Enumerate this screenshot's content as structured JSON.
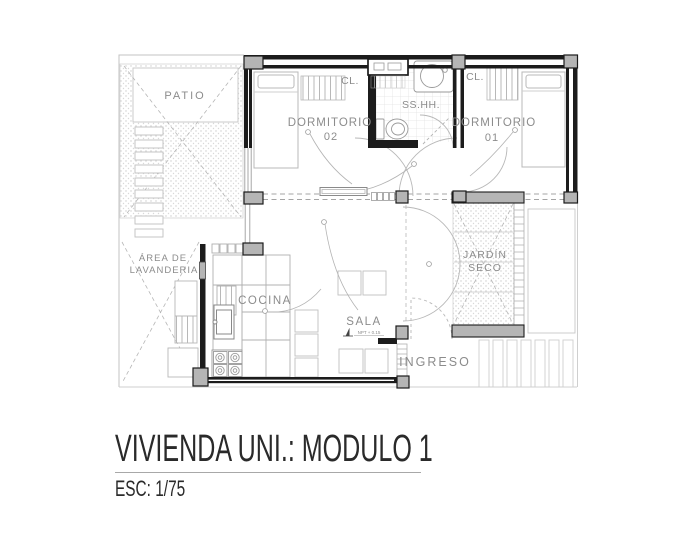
{
  "plan": {
    "labels": {
      "patio": "PATIO",
      "laundry_area": [
        "ÁREA DE",
        "LAVANDERIA"
      ],
      "bedroom_02": [
        "DORMITORIO",
        "02"
      ],
      "bedroom_01": [
        "DORMITORIO",
        "01"
      ],
      "bathroom": "SS.HH.",
      "closet_left": "CL.",
      "closet_right": "CL.",
      "kitchen": "COCINA",
      "living_room": "SALA",
      "living_room_level": "NPT + 0.15",
      "dry_garden": [
        "JARDÍN",
        "SECO"
      ],
      "entrance": "INGRESO"
    },
    "colors": {
      "walls": "#1c1c1c",
      "columns": "#b5b5b5",
      "thin_lines": "#c3c3c3",
      "labels": "#8c8c8c"
    }
  },
  "title_block": {
    "title": "VIVIENDA UNI.: MODULO 1",
    "scale": "ESC: 1/75"
  }
}
